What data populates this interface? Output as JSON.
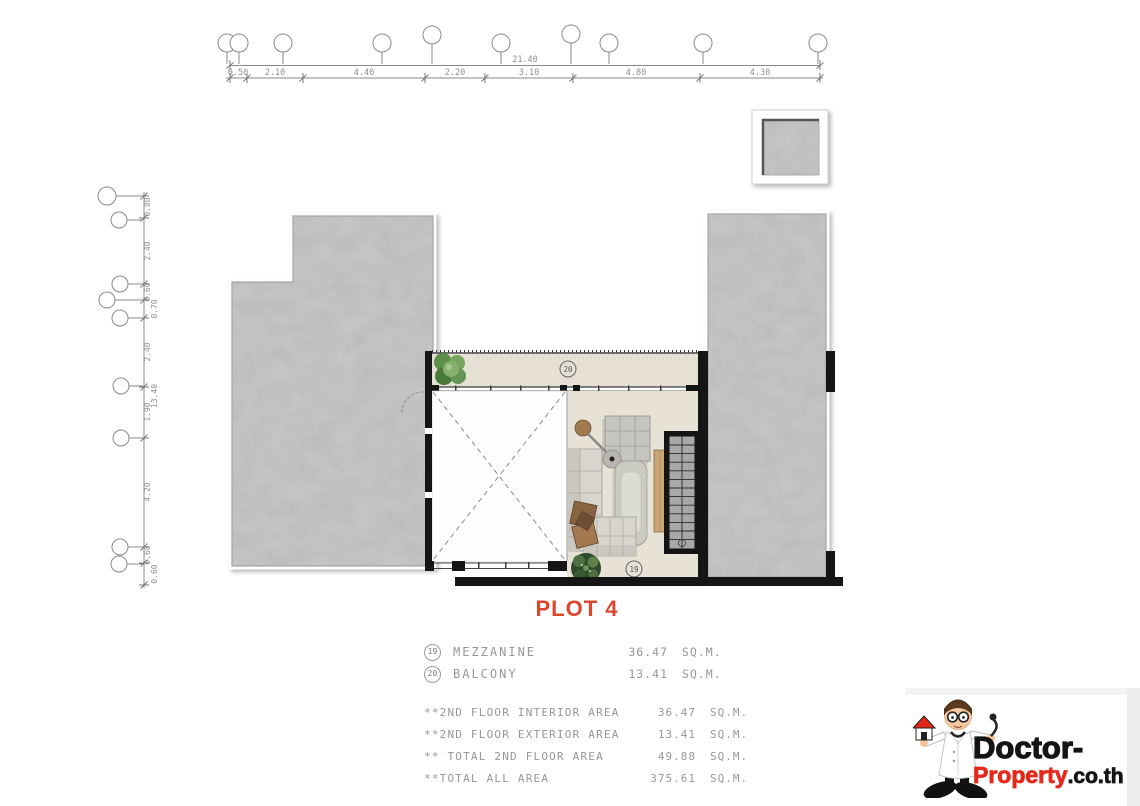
{
  "title": {
    "plot_label": "PLOT 4"
  },
  "dims": {
    "top": {
      "overall": "21.40",
      "segments": [
        "0.50",
        "2.10",
        "4.40",
        "2.20",
        "3.10",
        "4.80",
        "4.30"
      ]
    },
    "left": {
      "overall": "13.40",
      "segments": [
        "0.80",
        "2.40",
        "0.60",
        "0.70",
        "2.40",
        "1.90",
        "4.20",
        "0.60",
        "0.60"
      ]
    }
  },
  "plan": {
    "tags": {
      "mezzanine": "19",
      "balcony": "20"
    }
  },
  "legend": {
    "rows": [
      {
        "tag": "19",
        "label": "MEZZANINE",
        "value": "36.47",
        "unit": "SQ.M."
      },
      {
        "tag": "20",
        "label": "BALCONY",
        "value": "13.41",
        "unit": "SQ.M."
      }
    ]
  },
  "summary": {
    "rows": [
      {
        "label": "**2ND FLOOR INTERIOR AREA",
        "value": "36.47",
        "unit": "SQ.M."
      },
      {
        "label": "**2ND FLOOR EXTERIOR AREA",
        "value": "13.41",
        "unit": "SQ.M."
      },
      {
        "label": "** TOTAL 2ND  FLOOR AREA",
        "value": "49.88",
        "unit": "SQ.M."
      },
      {
        "label": "**TOTAL ALL AREA",
        "value": "375.61",
        "unit": "SQ.M."
      }
    ]
  },
  "logo": {
    "line1": "Doctor-",
    "line2_red": "Property",
    "line2_black": ".co.th"
  },
  "colors": {
    "accent_red": "#d9472e",
    "brand_red": "#e6291b",
    "concrete_gray": "#c8c9c7",
    "floor_beige": "#eae5d9",
    "wall_black": "#151515",
    "drawing_text": "#97979b"
  }
}
